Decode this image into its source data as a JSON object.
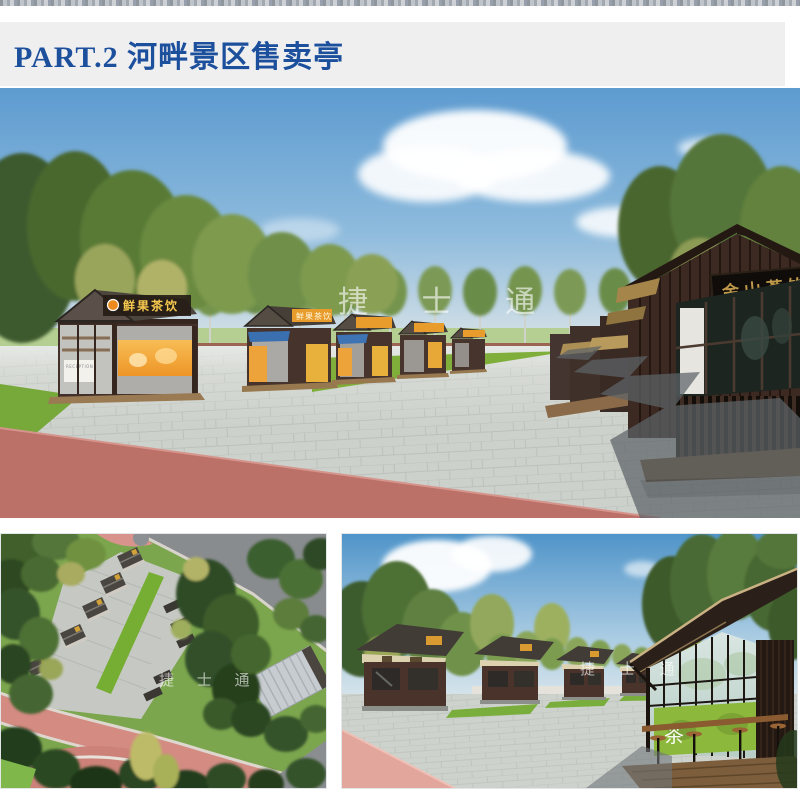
{
  "header": {
    "title": "PART.2 河畔景区售卖亭"
  },
  "watermark": {
    "text": "捷 士 通"
  },
  "palette": {
    "title_blue": "#1c4f9c",
    "title_band_bg": "#efeff0",
    "sky_blue": "#5d9bd0",
    "plaza_gray": "#cdd1cb",
    "grass_green": "#7fae3a",
    "kiosk_brown": "#43302a",
    "banner_orange": "#eda23a",
    "road_pink": "#bb7068",
    "sign_gold": "#c09a4a"
  },
  "main_render": {
    "kiosk_sign_1": "鲜果茶饮",
    "kiosk_sign_2": "鲜果茶饮",
    "counter_label": "RECEPTION",
    "building_sign": "金山茗饮"
  },
  "secondary_render": {
    "glass_decal": "茶"
  }
}
